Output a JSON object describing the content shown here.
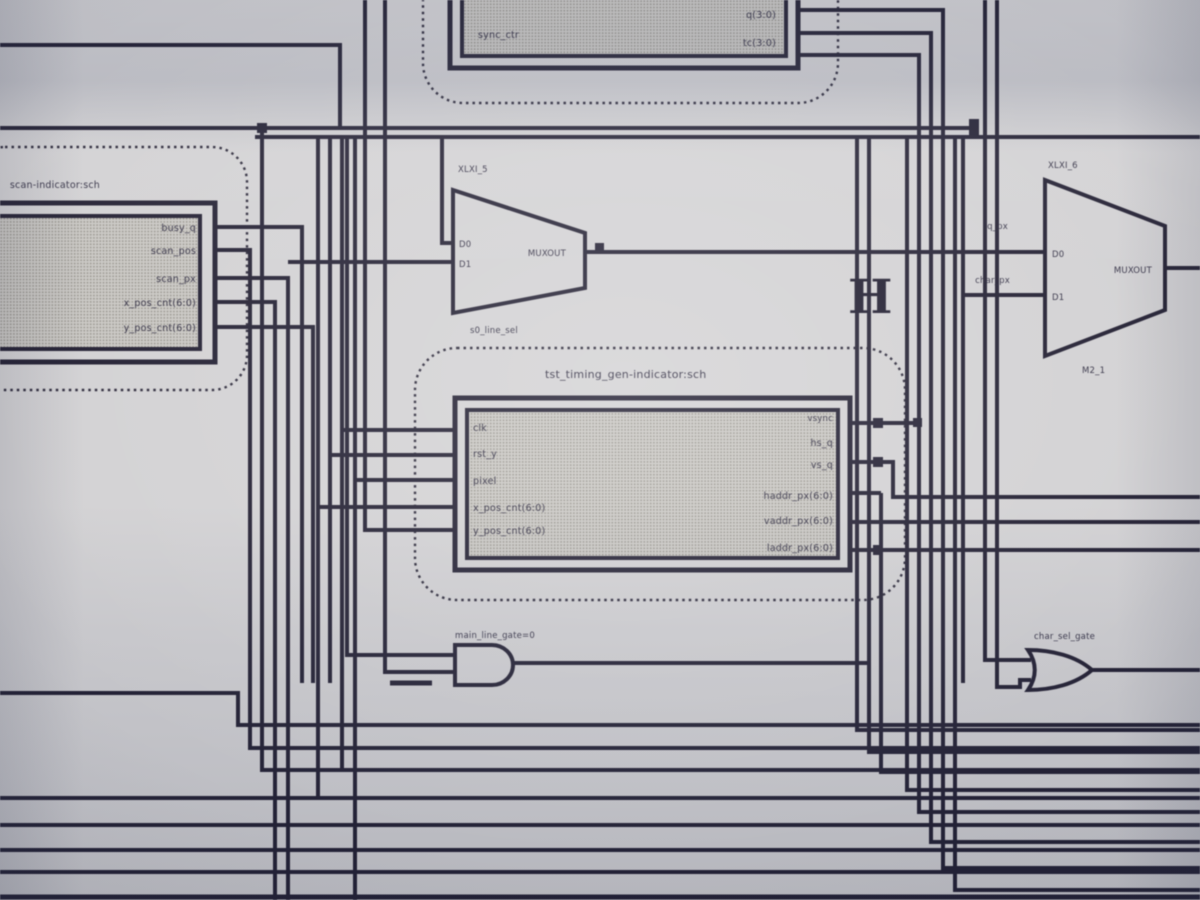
{
  "colors": {
    "ink": "#201d30",
    "paper": "#d2d1d3",
    "block_fill": "#c6c4bf"
  },
  "labels": {
    "sheet_tag": "H",
    "top_block": {
      "left_label": "sync_ctr",
      "right_ports": [
        "q(3:0)",
        "tc(3:0)"
      ]
    },
    "left_block": {
      "title": "scan-indicator:sch",
      "ports": [
        "busy_q",
        "scan_pos",
        "scan_px",
        "x_pos_cnt(6:0)",
        "y_pos_cnt(6:0)"
      ]
    },
    "center_block": {
      "title": "tst_timing_gen-indicator:sch",
      "left_ports": [
        "clk",
        "rst_y",
        "pixel",
        "x_pos_cnt(6:0)",
        "y_pos_cnt(6:0)"
      ],
      "right_ports": [
        "vsync",
        "hs_q",
        "vs_q",
        "haddr_px(6:0)",
        "vaddr_px(6:0)",
        "laddr_px(6:0)"
      ]
    },
    "mux_a": {
      "instance": "XLXI_5",
      "d0": "D0",
      "d1": "D1",
      "out": "MUXOUT",
      "type_label": "s0_line_sel"
    },
    "mux_b": {
      "instance": "XLXI_6",
      "d0": "D0",
      "d1": "D1",
      "out": "MUXOUT",
      "type_label": "M2_1",
      "net0": "q_px",
      "net1": "char_px"
    },
    "and_gate": {
      "net": "main_line_gate=0"
    },
    "or_gate": {
      "net": "char_sel_gate"
    }
  }
}
